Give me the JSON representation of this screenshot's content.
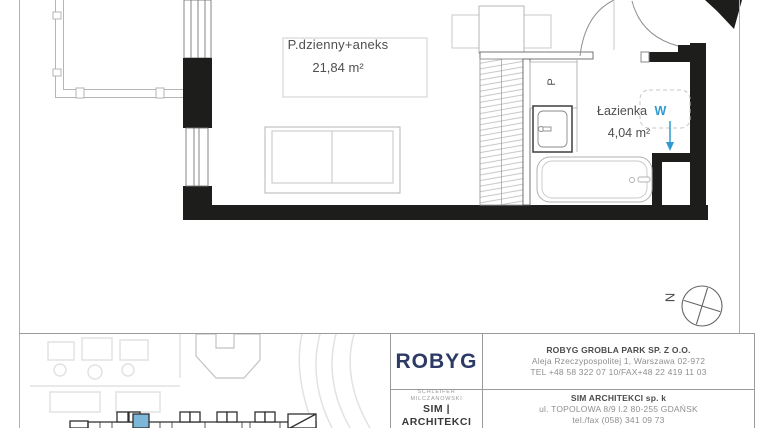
{
  "plan": {
    "living_room": {
      "name": "P.dzienny+aneks",
      "area": "21,84 m²"
    },
    "bathroom": {
      "name": "Łazienka",
      "area": "4,04 m²",
      "shaft_label": "W"
    },
    "washer_label": "P",
    "compass_label": "N"
  },
  "footer": {
    "developer": {
      "logo_text": "ROBYG",
      "company": "ROBYG GROBLA PARK SP. Z O.O.",
      "address": "Aleja Rzeczypospolitej 1, Warszawa 02-972",
      "phone": "TEL +48 58 322 07 10/FAX+48 22 419 11 03"
    },
    "architect": {
      "logo_top": "SCHLEIFER MILCZANOWSKI",
      "logo_main": "SIM | ARCHITEKCI",
      "company": "SIM ARCHITEKCI sp. k",
      "address": "ul. TOPOLOWA 8/9 l.2 80-255 GDAŃSK",
      "phone": "tel./fax (058) 341 09 73"
    }
  },
  "colors": {
    "wall_black": "#1d1d1b",
    "accent_blue": "#2e9ad0",
    "logo_navy": "#2c3a64",
    "highlighted_unit": "#7cb7da"
  }
}
